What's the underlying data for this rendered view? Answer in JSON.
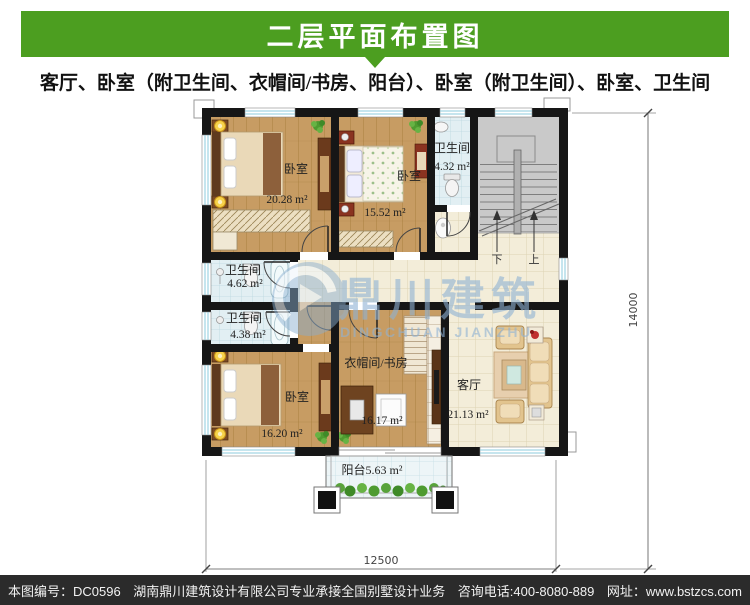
{
  "header": {
    "title": "二层平面布置图"
  },
  "subtitle": "客厅、卧室（附卫生间、衣帽间/书房、阳台）、卧室（附卫生间）、卧室、卫生间",
  "plan": {
    "rooms": {
      "bedroom_top_left": {
        "label": "卧室",
        "area": "20.28 m²"
      },
      "bedroom_top_mid": {
        "label": "卧室",
        "area": "15.52 m²"
      },
      "bath_top": {
        "label": "卫生间",
        "area": "4.32 m²"
      },
      "bath_mid_upper": {
        "label": "卫生间",
        "area": "4.62 m²"
      },
      "bath_mid_lower": {
        "label": "卫生间",
        "area": "4.38 m²"
      },
      "bedroom_bottom_left": {
        "label": "卧室",
        "area": "16.20 m²"
      },
      "cloak_study": {
        "label": "衣帽间/书房",
        "area": "16.17 m²"
      },
      "living_room": {
        "label": "客厅",
        "area": "21.13 m²"
      },
      "balcony": {
        "label": "阳台",
        "area": "5.63 m²"
      }
    },
    "stairs": {
      "down": "下",
      "up": "上"
    },
    "dimensions": {
      "width": "12500",
      "height": "14000"
    }
  },
  "watermark": {
    "name": "鼎川建筑",
    "latin": "DINGCHUAN JIANZHU"
  },
  "footer": {
    "drawing_no": "本图编号：DC0596",
    "company": "湖南鼎川建筑设计有限公司专业承接全国别墅设计业务",
    "phone": "咨询电话:400-8080-889",
    "website": "网址：www.bstzcs.com"
  },
  "colors": {
    "banner_green": "#4c9e20",
    "wall_black": "#161616",
    "wood_floor": "#c79c63",
    "tile_cream": "#f3edd9",
    "tile_bath": "#e2eff3",
    "stair_gray": "#c9c9c9",
    "window_blue": "#8ecbdd",
    "watermark_blue": "#8fb2d4",
    "footer_bg": "#2b2b2b"
  }
}
